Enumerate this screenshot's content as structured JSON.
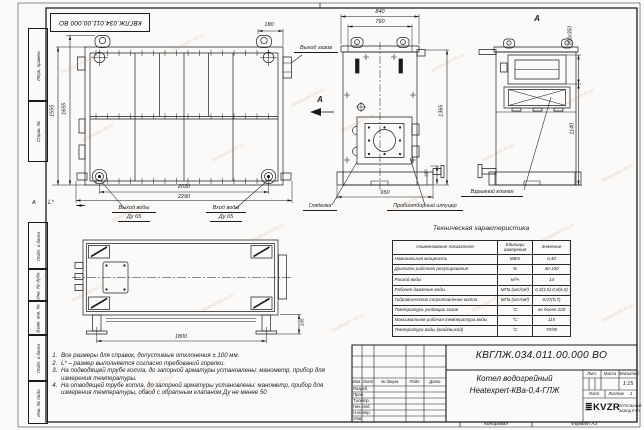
{
  "watermark": "heatexpert-kv.ru",
  "corner_stamp": "КВГЛЖ.034.011.00.000 ВО",
  "zone_letter": "А",
  "margin_fields": [
    "Перв. примен.",
    "Справ. №",
    "Подп. и дата",
    "Инв. № дубл.",
    "Взам. инв. №",
    "Подп. и дата",
    "Инв. № подл."
  ],
  "front_view": {
    "dim_180": "180",
    "dim_1555": "1555",
    "dim_1655": "1655",
    "dim_2030": "2030",
    "dim_2290": "2290",
    "dim_L": "L*",
    "label_gas_out": "Выход газов",
    "label_water_out": "Выход воды",
    "label_water_out_dn": "Ду 65",
    "label_water_in": "Вход воды",
    "label_water_in_dn": "Ду 65",
    "view_arrow": "А"
  },
  "side_view": {
    "dim_840": "840",
    "dim_760": "760",
    "dim_1365": "1365",
    "dim_180": "180",
    "dim_950": "950",
    "label_sight": "Гляделка",
    "label_sampler": "Пробоотборный штуцер"
  },
  "view_a": {
    "title": "А",
    "dim_200x350": "200х350",
    "dim_1140": "1140",
    "label_valve": "Взрывной клапан"
  },
  "top_view": {
    "dim_1800": "1800",
    "dim_195": "195"
  },
  "notes": [
    "Все размеры для справок, допустимые отклонения ± 100 мм.",
    "L* – размер выполняется согласно требований горелки.",
    "На подводящей трубе котла, до запорной арматуры установлены: манометр, прибор для измерения температуры.",
    "На отводящей трубе котла, до запорной арматуры установлены: манометр, прибор для измерения температуры, обвод с обратным клапаном Ду не менее 50"
  ],
  "spec_table": {
    "title": "Техническая характеристика",
    "headers": [
      "Наименование показателя",
      "Единицы измерения",
      "Значение"
    ],
    "rows": [
      [
        "Номинальная мощность",
        "МВт",
        "0,40"
      ],
      [
        "Диапазон рабочего регулирования",
        "%",
        "40-100"
      ],
      [
        "Расход воды",
        "м³/ч",
        "14"
      ],
      [
        "Рабочее давление воды",
        "МПа (кгс/см²)",
        "0,3(3,0)-0,6(6,0)"
      ],
      [
        "Гидравлическое сопротивление котла",
        "МПа (кгс/см²)",
        "0,07(0,7)"
      ],
      [
        "Температура уходящих газов",
        "°С",
        "не более 220"
      ],
      [
        "Максимальная рабочая температура воды",
        "°С",
        "115"
      ],
      [
        "Температура воды (вход/выход)",
        "°С",
        "70/95"
      ]
    ]
  },
  "title_block": {
    "doc_number": "КВГЛЖ.034.011.00.000 ВО",
    "title_line1": "Котел водогрейный",
    "title_line2": "Heatexpert-КВа-0,4-ГЛЖ",
    "cols": [
      "Изм.",
      "Лист",
      "№ докум.",
      "Подп.",
      "Дата"
    ],
    "rows": [
      "Разраб.",
      "Пров.",
      "Т.контр.",
      "Нач.отд.",
      "Н.контр.",
      "Утв."
    ],
    "lit_label": "Лит.",
    "mass_label": "Масса",
    "scale_label": "Масштаб",
    "scale_value": "1:15",
    "sheet_label": "Лист",
    "sheets_label": "Листов",
    "sheets_value": "1",
    "logo_text": "KVZR",
    "logo_sub1": "КОТЕЛЬНЫЙ",
    "logo_sub2": "ЗАВОД РЭП",
    "copied": "Копировал",
    "format": "Формат А3"
  }
}
